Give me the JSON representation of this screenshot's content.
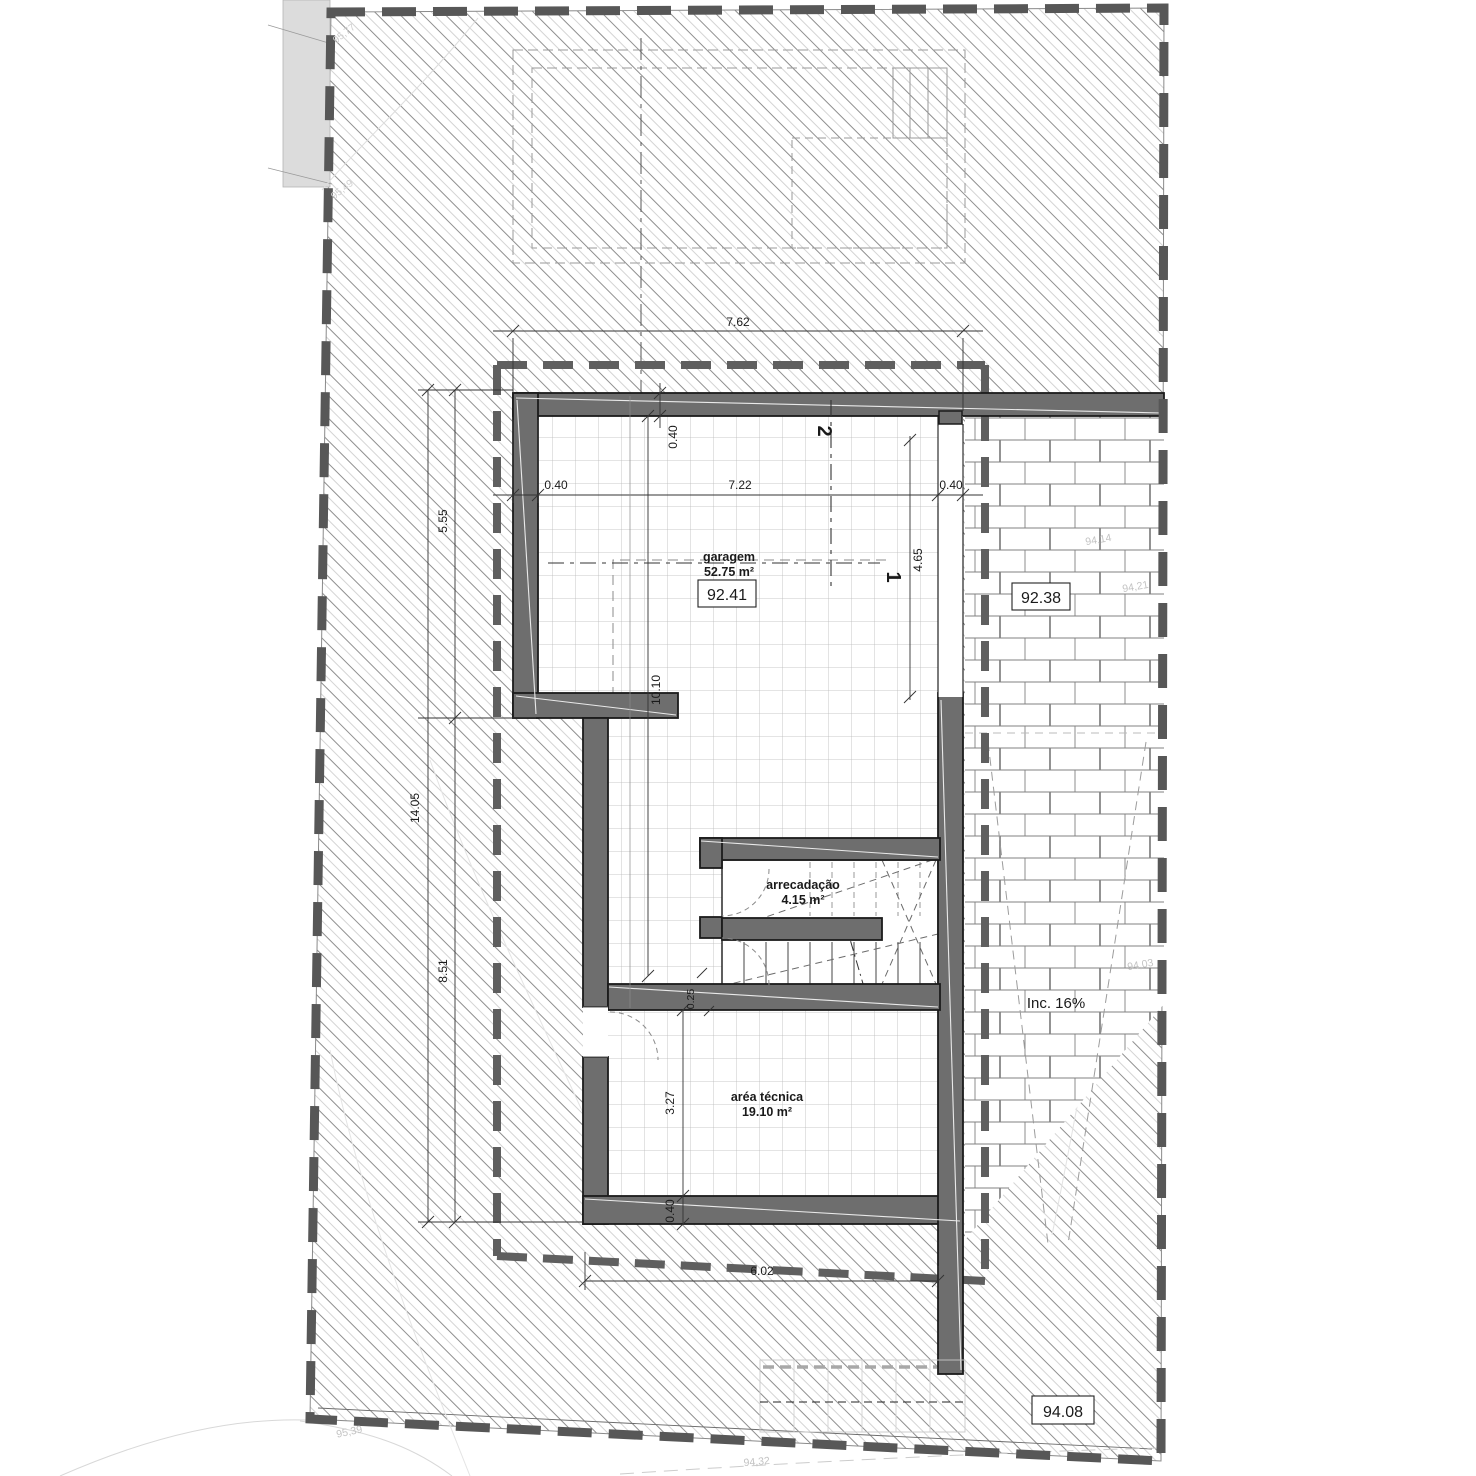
{
  "rooms": {
    "garage": {
      "name": "garagem",
      "area": "52.75 m²"
    },
    "storage": {
      "name": "arrecadação",
      "area": "4.15 m²"
    },
    "technical": {
      "name": "aréa técnica",
      "area": "19.10 m²"
    }
  },
  "levels": {
    "garage_floor": "92.41",
    "driveway": "92.38",
    "terrain": "94.08"
  },
  "ramp_label": "Inc. 16%",
  "dims": {
    "site_top": "7.62",
    "garage_clear": "7.22",
    "wall": "0.40",
    "door_side": "4.65",
    "garage_depth": "10.10",
    "left_upper": "5.55",
    "left_total": "14.05",
    "left_lower": "8.51",
    "tech_depth": "3.27",
    "int_wall": "0.25",
    "bottom": "6.02"
  },
  "sections": {
    "one": "1",
    "two": "2"
  },
  "contours": {
    "c1": "94,14",
    "c2": "94,21",
    "c3": "94,03",
    "c4": "95,39",
    "c5": "94,32",
    "c6": "95,77",
    "c7": "95,49"
  },
  "colors": {
    "wall": "#6e6e6e",
    "boundary": "#575757",
    "hatch_dark": "#8f8f8f",
    "hatch_light": "#d4d4d4",
    "grid": "#b9b9b9",
    "brick": "#808080"
  }
}
